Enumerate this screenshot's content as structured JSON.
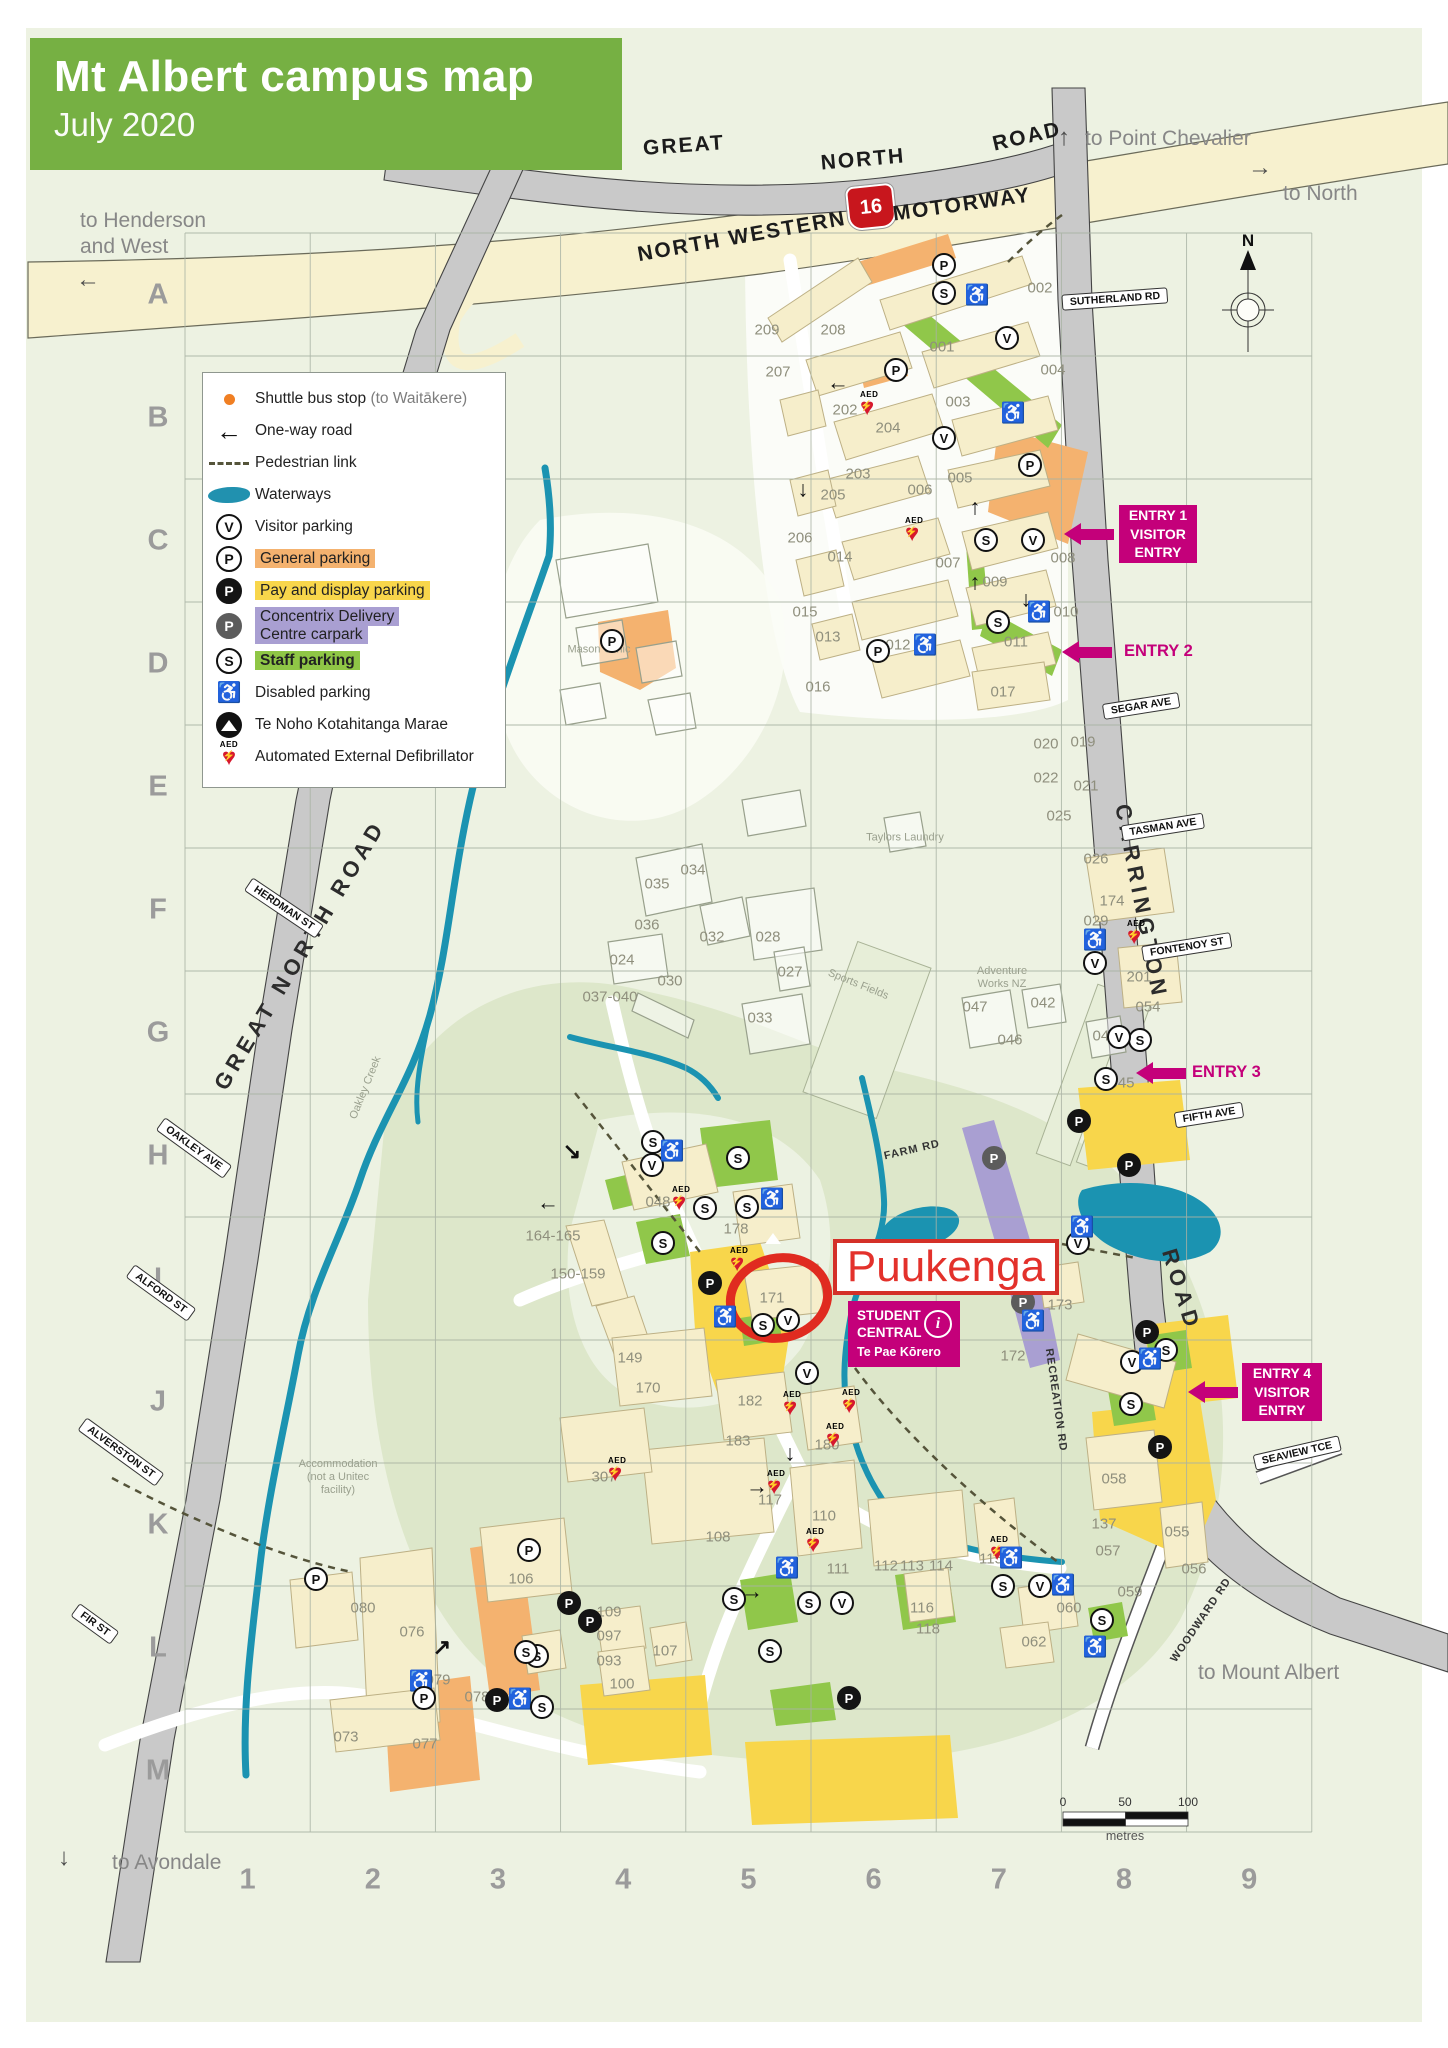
{
  "header": {
    "title": "Mt Albert campus map",
    "subtitle": "July 2020"
  },
  "colors": {
    "accent_green": "#76b043",
    "magenta": "#c4007a",
    "red": "#e3312b",
    "orange_parking": "#f4b26f",
    "yellow_parking": "#f8d64b",
    "purple_parking": "#a99fd2",
    "green_parking": "#90c74a",
    "water": "#1b93b1"
  },
  "icon_meta": {
    "v": "V",
    "p": "P",
    "pb": "P",
    "pg": "P",
    "s": "S",
    "dis": "♿",
    "aed_label": "AED",
    "aed_heart": "♥",
    "aed_bolt": "⚡"
  },
  "legend": {
    "items": [
      {
        "type": "dot",
        "label": "Shuttle bus stop ",
        "label_muted": "(to Waitākere)"
      },
      {
        "type": "oneway",
        "label": "One-way road"
      },
      {
        "type": "ped",
        "label": "Pedestrian link"
      },
      {
        "type": "water",
        "label": "Waterways"
      },
      {
        "type": "v",
        "label": "Visitor parking"
      },
      {
        "type": "p",
        "label": "General parking",
        "hl": "#f4b26f"
      },
      {
        "type": "pb",
        "label": "Pay and display parking",
        "hl": "#f8d64b"
      },
      {
        "type": "pg",
        "label": "Concentrix Delivery\nCentre carpark",
        "hl": "#a99fd2"
      },
      {
        "type": "s",
        "label": "Staff parking",
        "hl": "#8fc646",
        "bold": true
      },
      {
        "type": "dis",
        "label": "Disabled parking"
      },
      {
        "type": "marae",
        "label": "Te Noho Kotahitanga Marae"
      },
      {
        "type": "aed",
        "label": "Automated External Defibrillator"
      }
    ]
  },
  "grid": {
    "rows": [
      "A",
      "B",
      "C",
      "D",
      "E",
      "F",
      "G",
      "H",
      "I",
      "J",
      "K",
      "L",
      "M"
    ],
    "cols": [
      "1",
      "2",
      "3",
      "4",
      "5",
      "6",
      "7",
      "8",
      "9"
    ],
    "left": 185,
    "top": 233,
    "cellw": 125.2,
    "cellh": 123,
    "label_x": 158,
    "label_y": 1880
  },
  "compass": {
    "n": "N"
  },
  "scalebar": {
    "l0": "0",
    "l50": "50",
    "l100": "100",
    "unit": "metres"
  },
  "shield_text": "16",
  "road_names": [
    {
      "t": "GREAT",
      "x": 684,
      "y": 146,
      "r": -4
    },
    {
      "t": "NORTH",
      "x": 863,
      "y": 160,
      "r": -5
    },
    {
      "t": "ROAD",
      "x": 1027,
      "y": 137,
      "r": -13
    },
    {
      "t": "NORTH  WESTERN",
      "x": 742,
      "y": 237,
      "r": -10
    },
    {
      "t": "MOTORWAY",
      "x": 962,
      "y": 205,
      "r": -8
    },
    {
      "t": "GREAT  NORTH  ROAD",
      "x": 300,
      "y": 955,
      "r": -59,
      "sp": true
    },
    {
      "t": "CARRINGTON",
      "x": 1141,
      "y": 902,
      "r": 79,
      "sp": true
    },
    {
      "t": "ROAD",
      "x": 1181,
      "y": 1290,
      "r": 73,
      "sp": true
    },
    {
      "t": "FARM RD",
      "x": 912,
      "y": 1150,
      "r": -13,
      "small": true
    },
    {
      "t": "RECREATION RD",
      "x": 1056,
      "y": 1400,
      "r": 82,
      "small": true
    },
    {
      "t": "WOODWARD RD",
      "x": 1201,
      "y": 1620,
      "r": -56,
      "small": true
    }
  ],
  "street_pills": [
    {
      "t": "SUTHERLAND RD",
      "x": 1115,
      "y": 299,
      "r": -4
    },
    {
      "t": "SEGAR AVE",
      "x": 1141,
      "y": 706,
      "r": -9
    },
    {
      "t": "TASMAN AVE",
      "x": 1163,
      "y": 827,
      "r": -9
    },
    {
      "t": "FONTENOY ST",
      "x": 1187,
      "y": 947,
      "r": -9
    },
    {
      "t": "FIFTH AVE",
      "x": 1209,
      "y": 1115,
      "r": -9
    },
    {
      "t": "SEAVIEW TCE",
      "x": 1297,
      "y": 1453,
      "r": -13
    },
    {
      "t": "HERDMAN ST",
      "x": 284,
      "y": 908,
      "r": 34
    },
    {
      "t": "OAKLEY AVE",
      "x": 194,
      "y": 1148,
      "r": 36
    },
    {
      "t": "ALFORD ST",
      "x": 161,
      "y": 1293,
      "r": 36
    },
    {
      "t": "ALVERSTON ST",
      "x": 121,
      "y": 1452,
      "r": 36
    },
    {
      "t": "FIR ST",
      "x": 95,
      "y": 1624,
      "r": 36
    }
  ],
  "area_notes": [
    {
      "lines": [
        "Mason Clinic"
      ],
      "x": 599,
      "y": 650
    },
    {
      "lines": [
        "Taylors Laundry"
      ],
      "x": 905,
      "y": 838
    },
    {
      "lines": [
        "Adventure",
        "Works NZ"
      ],
      "x": 1002,
      "y": 978
    },
    {
      "lines": [
        "Sports Fields"
      ],
      "x": 858,
      "y": 985,
      "r": 22
    },
    {
      "lines": [
        "Oakley Creek"
      ],
      "x": 366,
      "y": 1088,
      "r": -68
    },
    {
      "lines": [
        "Accommodation",
        "(not a Unitec",
        "facility)"
      ],
      "x": 338,
      "y": 1478
    }
  ],
  "directions": [
    {
      "lines": [
        "to Henderson",
        "and West"
      ],
      "x": 80,
      "y": 208,
      "arrow": "←",
      "ax": 76,
      "ay": 268
    },
    {
      "lines": [
        "to Point Chevalier"
      ],
      "x": 1085,
      "y": 126,
      "arrow": "↑",
      "ax": 1058,
      "ay": 126
    },
    {
      "lines": [
        "to North"
      ],
      "x": 1283,
      "y": 181,
      "arrow": "→",
      "ax": 1248,
      "ay": 156
    },
    {
      "lines": [
        "to Mount Albert"
      ],
      "x": 1198,
      "y": 1660
    },
    {
      "lines": [
        "to Avondale"
      ],
      "x": 112,
      "y": 1850,
      "arrow": "↓",
      "ax": 58,
      "ay": 1846
    }
  ],
  "entries": [
    {
      "lines": [
        "ENTRY 1",
        "VISITOR",
        "ENTRY"
      ],
      "box": true,
      "x": 1119,
      "y": 505,
      "w": 78,
      "h": 58,
      "ax": 1066,
      "ay": 523
    },
    {
      "lines": [
        "ENTRY 2"
      ],
      "box": false,
      "x": 1124,
      "y": 642,
      "ax": 1064,
      "ay": 641
    },
    {
      "lines": [
        "ENTRY 3"
      ],
      "box": false,
      "x": 1192,
      "y": 1063,
      "ax": 1138,
      "ay": 1062
    },
    {
      "lines": [
        "ENTRY 4",
        "VISITOR",
        "ENTRY"
      ],
      "box": true,
      "x": 1242,
      "y": 1363,
      "w": 80,
      "h": 58,
      "ax": 1190,
      "ay": 1381
    }
  ],
  "callout": {
    "title": "Puukenga"
  },
  "student_central": {
    "l1": "STUDENT",
    "l2": "CENTRAL",
    "l3": "Te Pae Kōrero",
    "i": "i"
  },
  "building_labels": [
    {
      "id": "001",
      "x": 942,
      "y": 347
    },
    {
      "id": "002",
      "x": 1040,
      "y": 288
    },
    {
      "id": "003",
      "x": 958,
      "y": 402
    },
    {
      "id": "004",
      "x": 1053,
      "y": 370
    },
    {
      "id": "005",
      "x": 960,
      "y": 478
    },
    {
      "id": "006",
      "x": 920,
      "y": 490
    },
    {
      "id": "007",
      "x": 948,
      "y": 563
    },
    {
      "id": "008",
      "x": 1063,
      "y": 558
    },
    {
      "id": "009",
      "x": 995,
      "y": 582
    },
    {
      "id": "010",
      "x": 1066,
      "y": 612
    },
    {
      "id": "011",
      "x": 1016,
      "y": 642
    },
    {
      "id": "012",
      "x": 898,
      "y": 645
    },
    {
      "id": "013",
      "x": 828,
      "y": 637
    },
    {
      "id": "014",
      "x": 840,
      "y": 557
    },
    {
      "id": "015",
      "x": 805,
      "y": 612
    },
    {
      "id": "016",
      "x": 818,
      "y": 687
    },
    {
      "id": "017",
      "x": 1003,
      "y": 692
    },
    {
      "id": "202",
      "x": 845,
      "y": 410
    },
    {
      "id": "203",
      "x": 858,
      "y": 474
    },
    {
      "id": "204",
      "x": 888,
      "y": 428
    },
    {
      "id": "205",
      "x": 833,
      "y": 495
    },
    {
      "id": "206",
      "x": 800,
      "y": 538
    },
    {
      "id": "207",
      "x": 778,
      "y": 372
    },
    {
      "id": "208",
      "x": 833,
      "y": 330
    },
    {
      "id": "209",
      "x": 767,
      "y": 330
    },
    {
      "id": "019",
      "x": 1083,
      "y": 742
    },
    {
      "id": "020",
      "x": 1046,
      "y": 744
    },
    {
      "id": "021",
      "x": 1086,
      "y": 786
    },
    {
      "id": "022",
      "x": 1046,
      "y": 778
    },
    {
      "id": "025",
      "x": 1059,
      "y": 816
    },
    {
      "id": "026",
      "x": 1096,
      "y": 859
    },
    {
      "id": "029",
      "x": 1096,
      "y": 921
    },
    {
      "id": "024",
      "x": 622,
      "y": 960
    },
    {
      "id": "027",
      "x": 790,
      "y": 972
    },
    {
      "id": "028",
      "x": 768,
      "y": 937
    },
    {
      "id": "030",
      "x": 670,
      "y": 981
    },
    {
      "id": "032",
      "x": 712,
      "y": 937
    },
    {
      "id": "033",
      "x": 760,
      "y": 1018
    },
    {
      "id": "034",
      "x": 693,
      "y": 870
    },
    {
      "id": "035",
      "x": 657,
      "y": 884
    },
    {
      "id": "036",
      "x": 647,
      "y": 925
    },
    {
      "id": "037-040",
      "x": 610,
      "y": 997
    },
    {
      "id": "041",
      "x": 1105,
      "y": 1036
    },
    {
      "id": "042",
      "x": 1043,
      "y": 1003
    },
    {
      "id": "045",
      "x": 1122,
      "y": 1083
    },
    {
      "id": "046",
      "x": 1010,
      "y": 1040
    },
    {
      "id": "047",
      "x": 975,
      "y": 1007
    },
    {
      "id": "048",
      "x": 658,
      "y": 1202
    },
    {
      "id": "164-165",
      "x": 553,
      "y": 1236
    },
    {
      "id": "150-159",
      "x": 578,
      "y": 1274
    },
    {
      "id": "178",
      "x": 736,
      "y": 1229
    },
    {
      "id": "171",
      "x": 772,
      "y": 1298
    },
    {
      "id": "173",
      "x": 1060,
      "y": 1305
    },
    {
      "id": "172",
      "x": 1013,
      "y": 1356
    },
    {
      "id": "174",
      "x": 1112,
      "y": 901
    },
    {
      "id": "201",
      "x": 1139,
      "y": 977
    },
    {
      "id": "054",
      "x": 1148,
      "y": 1007
    },
    {
      "id": "149",
      "x": 630,
      "y": 1358
    },
    {
      "id": "170",
      "x": 648,
      "y": 1388
    },
    {
      "id": "182",
      "x": 750,
      "y": 1401
    },
    {
      "id": "183",
      "x": 738,
      "y": 1441
    },
    {
      "id": "180",
      "x": 827,
      "y": 1445
    },
    {
      "id": "307",
      "x": 604,
      "y": 1477
    },
    {
      "id": "117",
      "x": 770,
      "y": 1500
    },
    {
      "id": "110",
      "x": 824,
      "y": 1516
    },
    {
      "id": "108",
      "x": 718,
      "y": 1537
    },
    {
      "id": "111",
      "x": 838,
      "y": 1569
    },
    {
      "id": "112",
      "x": 886,
      "y": 1566
    },
    {
      "id": "113",
      "x": 912,
      "y": 1566
    },
    {
      "id": "114",
      "x": 941,
      "y": 1566
    },
    {
      "id": "115",
      "x": 991,
      "y": 1559
    },
    {
      "id": "116",
      "x": 922,
      "y": 1608
    },
    {
      "id": "118",
      "x": 928,
      "y": 1629
    },
    {
      "id": "106",
      "x": 521,
      "y": 1579
    },
    {
      "id": "109",
      "x": 609,
      "y": 1612
    },
    {
      "id": "097",
      "x": 609,
      "y": 1636
    },
    {
      "id": "093",
      "x": 609,
      "y": 1661
    },
    {
      "id": "100",
      "x": 622,
      "y": 1684
    },
    {
      "id": "107",
      "x": 665,
      "y": 1651
    },
    {
      "id": "076",
      "x": 412,
      "y": 1632
    },
    {
      "id": "080",
      "x": 363,
      "y": 1608
    },
    {
      "id": "079",
      "x": 438,
      "y": 1680
    },
    {
      "id": "078",
      "x": 477,
      "y": 1697
    },
    {
      "id": "073",
      "x": 346,
      "y": 1737
    },
    {
      "id": "077",
      "x": 425,
      "y": 1744
    },
    {
      "id": "058",
      "x": 1114,
      "y": 1479
    },
    {
      "id": "137",
      "x": 1104,
      "y": 1524
    },
    {
      "id": "055",
      "x": 1177,
      "y": 1532
    },
    {
      "id": "057",
      "x": 1108,
      "y": 1551
    },
    {
      "id": "056",
      "x": 1194,
      "y": 1569
    },
    {
      "id": "059",
      "x": 1130,
      "y": 1592
    },
    {
      "id": "060",
      "x": 1069,
      "y": 1608
    },
    {
      "id": "062",
      "x": 1034,
      "y": 1642
    }
  ],
  "map_icons": [
    {
      "t": "p",
      "x": 944,
      "y": 265
    },
    {
      "t": "s",
      "x": 944,
      "y": 293
    },
    {
      "t": "dis",
      "x": 977,
      "y": 296
    },
    {
      "t": "v",
      "x": 1007,
      "y": 338
    },
    {
      "t": "p",
      "x": 896,
      "y": 370
    },
    {
      "t": "aed",
      "x": 860,
      "y": 392
    },
    {
      "t": "dis",
      "x": 1013,
      "y": 414
    },
    {
      "t": "v",
      "x": 944,
      "y": 438
    },
    {
      "t": "p",
      "x": 1030,
      "y": 465
    },
    {
      "t": "aed",
      "x": 905,
      "y": 518
    },
    {
      "t": "s",
      "x": 986,
      "y": 540
    },
    {
      "t": "v",
      "x": 1033,
      "y": 540
    },
    {
      "t": "dis",
      "x": 1039,
      "y": 613
    },
    {
      "t": "s",
      "x": 998,
      "y": 622
    },
    {
      "t": "dis",
      "x": 925,
      "y": 646
    },
    {
      "t": "p",
      "x": 878,
      "y": 651
    },
    {
      "t": "p",
      "x": 612,
      "y": 641
    },
    {
      "t": "arr",
      "g": "←",
      "x": 838,
      "y": 383
    },
    {
      "t": "arr",
      "g": "↓",
      "x": 803,
      "y": 490
    },
    {
      "t": "arr",
      "g": "↑",
      "x": 975,
      "y": 508
    },
    {
      "t": "arr",
      "g": "↑",
      "x": 975,
      "y": 583
    },
    {
      "t": "arr",
      "g": "↓",
      "x": 1026,
      "y": 600
    },
    {
      "t": "s",
      "x": 738,
      "y": 1158
    },
    {
      "t": "s",
      "x": 653,
      "y": 1142
    },
    {
      "t": "v",
      "x": 652,
      "y": 1165
    },
    {
      "t": "dis",
      "x": 672,
      "y": 1152
    },
    {
      "t": "aed",
      "x": 672,
      "y": 1187
    },
    {
      "t": "s",
      "x": 705,
      "y": 1208
    },
    {
      "t": "s",
      "x": 663,
      "y": 1243
    },
    {
      "t": "s",
      "x": 747,
      "y": 1207
    },
    {
      "t": "dis",
      "x": 772,
      "y": 1200
    },
    {
      "t": "marae",
      "x": 760,
      "y": 1225
    },
    {
      "t": "aed",
      "x": 730,
      "y": 1248
    },
    {
      "t": "pb",
      "x": 710,
      "y": 1283
    },
    {
      "t": "dis",
      "x": 725,
      "y": 1318
    },
    {
      "t": "s",
      "x": 763,
      "y": 1325
    },
    {
      "t": "v",
      "x": 788,
      "y": 1320
    },
    {
      "t": "v",
      "x": 807,
      "y": 1373
    },
    {
      "t": "aed",
      "x": 783,
      "y": 1392
    },
    {
      "t": "aed",
      "x": 842,
      "y": 1390
    },
    {
      "t": "pg",
      "x": 994,
      "y": 1158
    },
    {
      "t": "pg",
      "x": 1023,
      "y": 1302
    },
    {
      "t": "dis",
      "x": 1033,
      "y": 1322
    },
    {
      "t": "pb",
      "x": 1079,
      "y": 1121
    },
    {
      "t": "pb",
      "x": 1129,
      "y": 1165
    },
    {
      "t": "aed",
      "x": 1127,
      "y": 921
    },
    {
      "t": "dis",
      "x": 1095,
      "y": 941
    },
    {
      "t": "v",
      "x": 1095,
      "y": 963
    },
    {
      "t": "s",
      "x": 1140,
      "y": 1040
    },
    {
      "t": "v",
      "x": 1119,
      "y": 1037
    },
    {
      "t": "s",
      "x": 1106,
      "y": 1079
    },
    {
      "t": "v",
      "x": 1078,
      "y": 1243
    },
    {
      "t": "dis",
      "x": 1082,
      "y": 1228
    },
    {
      "t": "pb",
      "x": 1147,
      "y": 1332
    },
    {
      "t": "s",
      "x": 1166,
      "y": 1350
    },
    {
      "t": "v",
      "x": 1132,
      "y": 1362
    },
    {
      "t": "dis",
      "x": 1150,
      "y": 1360
    },
    {
      "t": "s",
      "x": 1131,
      "y": 1404
    },
    {
      "t": "pb",
      "x": 1160,
      "y": 1447
    },
    {
      "t": "arr",
      "g": "↘",
      "x": 572,
      "y": 1152
    },
    {
      "t": "arr",
      "g": "←",
      "x": 548,
      "y": 1203
    },
    {
      "t": "arr",
      "g": "→",
      "x": 757,
      "y": 1487
    },
    {
      "t": "arr",
      "g": "↓",
      "x": 790,
      "y": 1454
    },
    {
      "t": "arr",
      "g": "→",
      "x": 752,
      "y": 1592
    },
    {
      "t": "arr",
      "g": "↗",
      "x": 442,
      "y": 1648
    },
    {
      "t": "aed",
      "x": 608,
      "y": 1458
    },
    {
      "t": "aed",
      "x": 767,
      "y": 1471
    },
    {
      "t": "aed",
      "x": 826,
      "y": 1424
    },
    {
      "t": "aed",
      "x": 806,
      "y": 1529
    },
    {
      "t": "aed",
      "x": 990,
      "y": 1537
    },
    {
      "t": "dis",
      "x": 1011,
      "y": 1559
    },
    {
      "t": "dis",
      "x": 787,
      "y": 1569
    },
    {
      "t": "s",
      "x": 734,
      "y": 1599
    },
    {
      "t": "s",
      "x": 809,
      "y": 1603
    },
    {
      "t": "v",
      "x": 842,
      "y": 1603
    },
    {
      "t": "s",
      "x": 1003,
      "y": 1586
    },
    {
      "t": "v",
      "x": 1040,
      "y": 1586
    },
    {
      "t": "dis",
      "x": 1063,
      "y": 1586
    },
    {
      "t": "s",
      "x": 1102,
      "y": 1620
    },
    {
      "t": "dis",
      "x": 1095,
      "y": 1648
    },
    {
      "t": "dot",
      "x": 911,
      "y": 1625
    },
    {
      "t": "pb",
      "x": 569,
      "y": 1603
    },
    {
      "t": "pb",
      "x": 590,
      "y": 1621
    },
    {
      "t": "s",
      "x": 537,
      "y": 1656
    },
    {
      "t": "s",
      "x": 526,
      "y": 1652
    },
    {
      "t": "p",
      "x": 529,
      "y": 1550
    },
    {
      "t": "p",
      "x": 316,
      "y": 1579
    },
    {
      "t": "dis",
      "x": 421,
      "y": 1682
    },
    {
      "t": "p",
      "x": 424,
      "y": 1698
    },
    {
      "t": "pb",
      "x": 497,
      "y": 1700
    },
    {
      "t": "dis",
      "x": 520,
      "y": 1700
    },
    {
      "t": "s",
      "x": 542,
      "y": 1707
    },
    {
      "t": "s",
      "x": 770,
      "y": 1651
    },
    {
      "t": "pb",
      "x": 849,
      "y": 1698
    }
  ]
}
